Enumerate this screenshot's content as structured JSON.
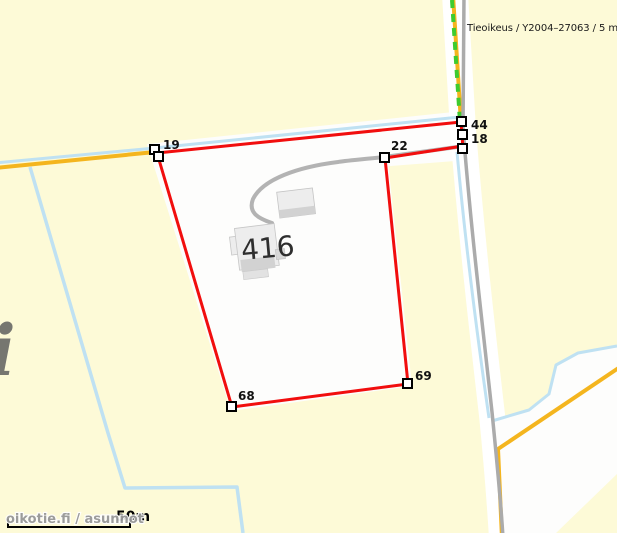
{
  "map": {
    "tooltip": "Tieoikeus / Y2004–27063 / 5 m",
    "parcel_number": "416",
    "vertex_labels": {
      "v19": "19",
      "v22": "22",
      "v44": "44",
      "v18": "18",
      "v68": "68",
      "v69": "69"
    },
    "scale": {
      "label": "50m"
    },
    "watermark": {
      "text": "oikotie.fi / asunnot",
      "big_letter": "i"
    },
    "colors": {
      "background": "#FDFAD7",
      "parcel_fill": "#FDFDFC",
      "boundary_red": "#F10E0E",
      "road_orange": "#F4B51E",
      "road_gray": "#ABABAB",
      "water_blue": "#BFE1F2",
      "usage_right_green": "#3ECB30",
      "building_fill": "#EDEDED",
      "building_shadow": "#D2D2D2"
    }
  }
}
